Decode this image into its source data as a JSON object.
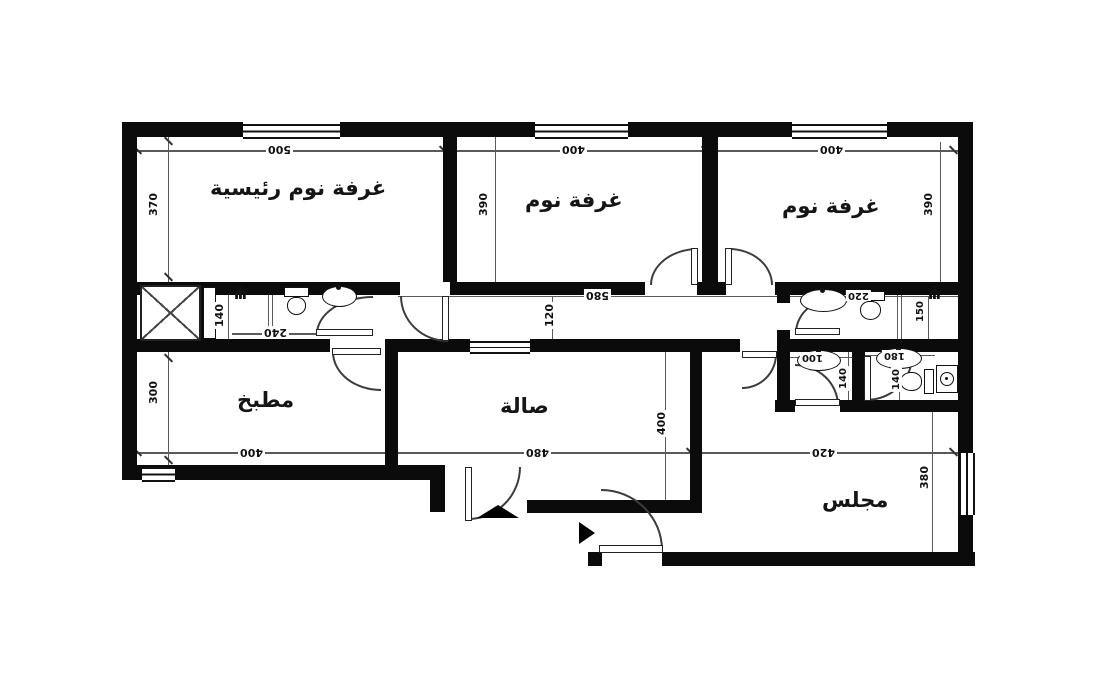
{
  "plan_title": "apartment-floor-plan",
  "rooms": {
    "master_bedroom": {
      "label": "غرفة نوم رئيسية",
      "width": "500",
      "height": "370"
    },
    "bedroom_2": {
      "label": "غرفة نوم",
      "width": "400",
      "height": "390"
    },
    "bedroom_3": {
      "label": "غرفة نوم",
      "width": "400",
      "height": "390"
    },
    "kitchen": {
      "label": "مطبخ",
      "width": "400",
      "height": "300"
    },
    "hall": {
      "label": "صالة",
      "width": "480",
      "height": "400"
    },
    "majlis": {
      "label": "مجلس",
      "width": "420",
      "height": "380"
    },
    "master_bath": {
      "width": "240",
      "height": "140"
    },
    "corridor": {
      "width": "580",
      "height": "120"
    },
    "bath_2": {
      "width": "220",
      "height": "150"
    },
    "wc_1": {
      "width": "100",
      "height": "140"
    },
    "wc_2": {
      "width": "180",
      "height": "140"
    }
  }
}
